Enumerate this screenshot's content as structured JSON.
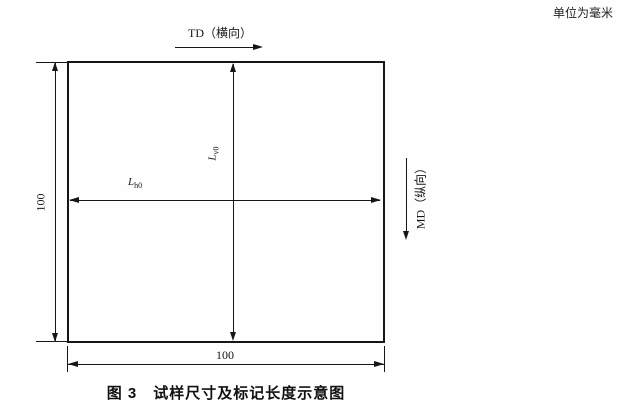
{
  "unit_note": "单位为毫米",
  "figure_caption": "图 3　试样尺寸及标记长度示意图",
  "diagram": {
    "td_axis_label": "TD（横向）",
    "md_axis_label": "MD（纵向）",
    "specimen_width_mm": "100",
    "specimen_height_mm": "100",
    "gauge_h": {
      "symbol": "L",
      "subscript": "h0"
    },
    "gauge_v": {
      "symbol": "L",
      "subscript": "v0"
    },
    "line_color": "#161616",
    "background_color": "#ffffff"
  }
}
